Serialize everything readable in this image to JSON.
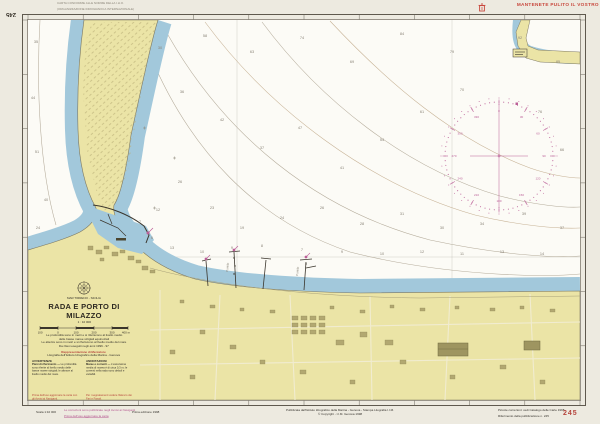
{
  "frame": {
    "sheet_number_top": "245",
    "top_note_line1": "CARTA CONFORME ALLE NORME DELLA I.H.O.",
    "top_note_line2": "(ORGANIZZAZIONE IDROGRAFICA INTERNAZIONALE)",
    "clean_sea": "MANTENETE PULITO IL VOSTRO MARE"
  },
  "title_block": {
    "region": "MAR TIRRENO - SICILIA",
    "title": "RADA E PORTO DI MILAZZO",
    "scale": "1 : 10 000",
    "scalebar": [
      "100",
      "0",
      "100",
      "200",
      "300",
      "400 m"
    ],
    "note1": "Le profondità sono in metri e si riferiscono al livello medio",
    "note2": "delle basse maree sizigiali equinoziali",
    "note3": "Le altezze sono in metri e si riferiscono al livello medio del mare",
    "survey": "Da rilievi eseguiti negli anni 1996 - 97",
    "projection": "Rappresentazione di Mercatore",
    "projection_sub": "Litografia dell'Istituto Idrografico della Marina - Genova",
    "col_left": {
      "header": "AVVERTENZE",
      "lead": "Piani di riferimento —",
      "body": "Le profondità sono riferite al livello medio delle basse maree sizigiali; le altezze al livello medio del mare.",
      "red": "Prima dell'uso aggiornare la carta con gli Avvisi ai Naviganti."
    },
    "col_right": {
      "header": "ANNOTAZIONI",
      "lead": "Maree e correnti —",
      "body": "L'escursione media di marea è di circa 0,3 m; le correnti nella rada sono deboli e variabili.",
      "red": "Per i segnalamenti vedere l'Elenco dei Fari e Fanali."
    }
  },
  "footer": {
    "scale_note": "Scala 1:10 000",
    "corrections_line1": "Le correzioni sono pubblicate negli Avvisi ai Naviganti",
    "corrections_line2": "Prima dell'uso aggiornare la carta",
    "edition_note": "Prima edizione 1998",
    "publisher_line1": "Pubblicata dall'Istituto Idrografico della Marina - Genova - Stampa Litografia I.I.M.",
    "publisher_line2": "© Copyright - I.I.M. Genova 1998",
    "right_note_line1": "Piccole correzioni: vedi Catalogo delle Carte 1998",
    "right_note_line2": "Riferimento della pubblicazione n. 245",
    "sheet_number": "245"
  },
  "map": {
    "pier_label_1": "Pontile",
    "pier_label_2": "Pontile",
    "compass": {
      "cx": 499,
      "cy": 156,
      "r": 54,
      "color": "#bb5f97",
      "numbers": [
        "0",
        "30",
        "60",
        "90",
        "120",
        "150",
        "180",
        "210",
        "240",
        "270",
        "300",
        "330"
      ]
    },
    "soundings": [
      [
        36,
        42,
        "35"
      ],
      [
        33,
        98,
        "44"
      ],
      [
        37,
        152,
        "51"
      ],
      [
        46,
        200,
        "40"
      ],
      [
        38,
        228,
        "24"
      ],
      [
        160,
        48,
        "30"
      ],
      [
        205,
        36,
        "58"
      ],
      [
        252,
        52,
        "63"
      ],
      [
        302,
        38,
        "74"
      ],
      [
        352,
        62,
        "69"
      ],
      [
        402,
        34,
        "84"
      ],
      [
        452,
        52,
        "79"
      ],
      [
        520,
        38,
        "92"
      ],
      [
        558,
        62,
        "85"
      ],
      [
        182,
        92,
        "36"
      ],
      [
        222,
        120,
        "42"
      ],
      [
        262,
        148,
        "37"
      ],
      [
        300,
        128,
        "47"
      ],
      [
        342,
        168,
        "41"
      ],
      [
        382,
        140,
        "54"
      ],
      [
        422,
        112,
        "61"
      ],
      [
        462,
        90,
        "70"
      ],
      [
        540,
        112,
        "76"
      ],
      [
        562,
        150,
        "66"
      ],
      [
        180,
        182,
        "26"
      ],
      [
        212,
        208,
        "23"
      ],
      [
        242,
        228,
        "19"
      ],
      [
        282,
        218,
        "24"
      ],
      [
        322,
        208,
        "26"
      ],
      [
        362,
        224,
        "28"
      ],
      [
        402,
        214,
        "31"
      ],
      [
        442,
        228,
        "30"
      ],
      [
        482,
        224,
        "34"
      ],
      [
        524,
        214,
        "39"
      ],
      [
        562,
        228,
        "37"
      ],
      [
        172,
        248,
        "13"
      ],
      [
        202,
        252,
        "10"
      ],
      [
        232,
        248,
        "9"
      ],
      [
        262,
        246,
        "8"
      ],
      [
        302,
        250,
        "7"
      ],
      [
        342,
        252,
        "9"
      ],
      [
        382,
        254,
        "10"
      ],
      [
        422,
        252,
        "12"
      ],
      [
        462,
        254,
        "11"
      ],
      [
        502,
        252,
        "13"
      ],
      [
        542,
        254,
        "14"
      ],
      [
        152,
        238,
        "6"
      ],
      [
        140,
        222,
        "7"
      ],
      [
        158,
        210,
        "12"
      ]
    ],
    "colors": {
      "sea": "#fcfbf6",
      "coastal_water": "#a2c8db",
      "land": "#ebe4a6",
      "magenta": "#bb5f97",
      "red": "#c8473c"
    }
  }
}
